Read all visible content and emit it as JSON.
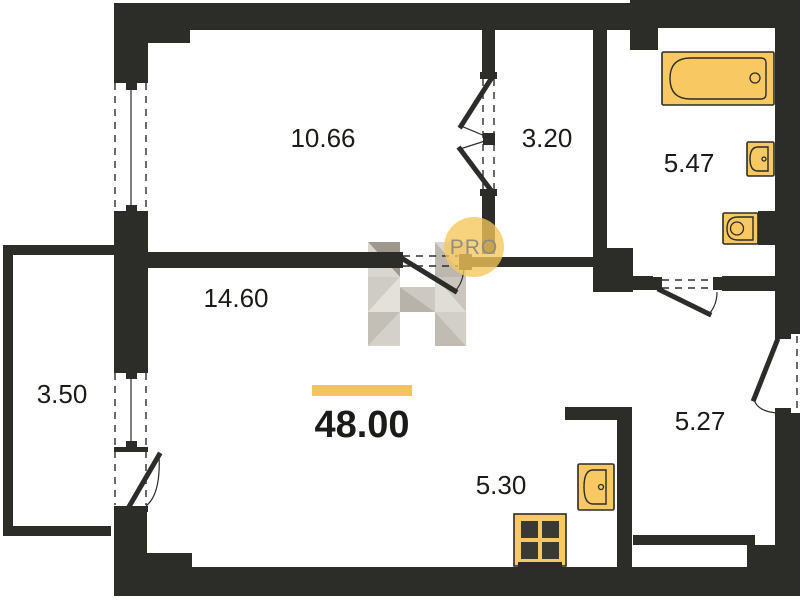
{
  "plan_title": "Apartment floor plan, total area 48.00 sq.m",
  "colors": {
    "background": "#ffffff",
    "wall": "#2c2c29",
    "fixture_fill": "#F8C962",
    "fixture_stroke": "#2b2b27",
    "burner": "#3a3a34",
    "label_text": "#1b1b18",
    "accent_bar": "#F2C461",
    "pro_circle": "#F6C75A",
    "pro_text": "#8b8b84",
    "h_facets": [
      "#9d978d",
      "#d9d6cf",
      "#cfccc5",
      "#e4e1db",
      "#c3bfb7",
      "#d4d1ca",
      "#d9d6cf",
      "#bcb8b0",
      "#cac6bf",
      "#e0ddd7",
      "#d2cfc8",
      "#c0bcb4",
      "#cdc9c2",
      "#b7b3aa"
    ]
  },
  "rooms": [
    {
      "id": "room-top-left",
      "area": "10.66",
      "x": 323,
      "y": 147
    },
    {
      "id": "hallway",
      "area": "3.20",
      "x": 547,
      "y": 147
    },
    {
      "id": "bathroom",
      "area": "5.47",
      "x": 689,
      "y": 172
    },
    {
      "id": "living-room",
      "area": "14.60",
      "x": 236,
      "y": 307
    },
    {
      "id": "balcony",
      "area": "3.50",
      "x": 62,
      "y": 403
    },
    {
      "id": "kitchen",
      "area": "5.30",
      "x": 501,
      "y": 494
    },
    {
      "id": "room-bottom-right",
      "area": "5.27",
      "x": 700,
      "y": 430
    }
  ],
  "total_area": {
    "value": "48.00",
    "x": 362,
    "y": 437,
    "font_size": 38,
    "bar": [
      312,
      385,
      100,
      11
    ]
  },
  "watermark": {
    "pro_text": "PRO",
    "cx": 474,
    "cy": 247,
    "r": 30,
    "text_y": 254
  },
  "geometry": {
    "walls": [
      [
        114,
        3,
        34,
        75
      ],
      [
        148,
        3,
        42,
        40
      ],
      [
        188,
        3,
        442,
        27
      ],
      [
        630,
        0,
        170,
        28
      ],
      [
        630,
        28,
        28,
        22
      ],
      [
        775,
        28,
        25,
        306
      ],
      [
        775,
        413,
        25,
        183
      ],
      [
        190,
        567,
        610,
        29
      ],
      [
        147,
        553,
        45,
        43
      ],
      [
        114,
        512,
        33,
        84
      ],
      [
        114,
        216,
        34,
        151
      ],
      [
        3,
        245,
        112,
        10
      ],
      [
        3,
        245,
        10,
        291
      ],
      [
        3,
        526,
        108,
        10
      ],
      [
        482,
        30,
        13,
        43
      ],
      [
        482,
        196,
        13,
        58
      ],
      [
        148,
        252,
        254,
        16
      ],
      [
        459,
        254,
        13,
        16
      ],
      [
        472,
        257,
        121,
        10
      ],
      [
        593,
        25,
        14,
        225
      ],
      [
        593,
        248,
        40,
        44
      ],
      [
        633,
        276,
        20,
        14
      ],
      [
        722,
        276,
        53,
        15
      ],
      [
        565,
        407,
        67,
        13
      ],
      [
        617,
        420,
        15,
        150
      ],
      [
        633,
        535,
        122,
        10
      ],
      [
        747,
        545,
        28,
        24
      ],
      [
        758,
        211,
        17,
        34
      ]
    ],
    "caps": [
      [
        114,
        77,
        34,
        6
      ],
      [
        126,
        83,
        11,
        7
      ],
      [
        126,
        205,
        11,
        7
      ],
      [
        114,
        211,
        34,
        6
      ],
      [
        114,
        367,
        34,
        6
      ],
      [
        126,
        373,
        11,
        6
      ],
      [
        126,
        441,
        11,
        6
      ],
      [
        114,
        447,
        34,
        5
      ],
      [
        114,
        506,
        34,
        6
      ],
      [
        480,
        72,
        17,
        7
      ],
      [
        480,
        189,
        17,
        7
      ],
      [
        483,
        133,
        12,
        12
      ],
      [
        653,
        277,
        9,
        13
      ],
      [
        713,
        277,
        9,
        13
      ],
      [
        775,
        333,
        16,
        6
      ],
      [
        775,
        408,
        16,
        6
      ],
      [
        395,
        252,
        8,
        16
      ]
    ],
    "dashed_lines": [
      [
        115,
        83,
        115,
        210
      ],
      [
        146,
        83,
        146,
        210
      ],
      [
        115,
        373,
        115,
        505
      ],
      [
        146,
        373,
        146,
        505
      ],
      [
        483,
        79,
        483,
        189
      ],
      [
        494,
        79,
        494,
        189
      ],
      [
        403,
        256,
        458,
        256
      ],
      [
        403,
        266,
        458,
        266
      ],
      [
        662,
        280,
        713,
        280
      ],
      [
        662,
        288,
        713,
        288
      ],
      [
        797,
        336,
        797,
        411
      ]
    ],
    "glazing_lines": [
      [
        131,
        85,
        131,
        205
      ],
      [
        131,
        378,
        131,
        441
      ]
    ],
    "door_panels": [
      [
        491,
        79,
        461,
        126
      ],
      [
        460,
        149,
        490,
        189
      ],
      [
        403,
        259,
        455,
        291
      ],
      [
        660,
        290,
        709,
        314
      ],
      [
        130,
        505,
        159,
        455
      ],
      [
        777,
        341,
        754,
        399
      ]
    ],
    "door_thin_lines": [
      [
        461,
        126,
        485,
        136
      ],
      [
        460,
        149,
        485,
        141
      ]
    ],
    "door_arcs": [
      "M455,291 Q463,283 464,268",
      "M709,314 Q717,305 717,292",
      "M159,455 Q161,494 146,506",
      "M754,399 Q757,412 779,413"
    ],
    "h_watermark_polys": [
      "368,242 400,242 400,277",
      "368,242 368,277 400,277",
      "368,277 400,277 368,312",
      "400,277 400,312 368,312",
      "368,312 400,312 368,346",
      "400,312 400,346 368,346",
      "435,242 466,242 466,277",
      "435,242 435,277 466,277",
      "435,277 466,277 466,312",
      "435,277 435,312 466,312",
      "435,312 466,312 466,346",
      "435,312 435,346 466,346",
      "400,287 435,287 435,312",
      "400,287 400,312 435,312"
    ],
    "fixtures": {
      "bathtub": {
        "outer": [
          662,
          52,
          112,
          53
        ],
        "inner": "M 690.5 58 L 761 58 Q 766 58 766 63 L 766 94 Q 766 99 761 99 L 690.5 99 Q 670 99 670 78.5 Q 670 58 690.5 58 Z",
        "drain": [
          755,
          78,
          5
        ]
      },
      "bath_sink": {
        "outer": [
          747,
          142,
          27,
          34
        ],
        "inner": "M 758 147 L 768 147 L 768 171 L 758 171 Q 750 171 750 159 Q 750 147 758 147 Z",
        "drain": [
          764,
          159,
          2
        ]
      },
      "toilet": {
        "outer": [
          723,
          213,
          35,
          31
        ],
        "inner": "M 738 217 L 753 217 L 753 240 L 738 240 Q 727 240 727 228.5 Q 727 217 738 217 Z",
        "drain": [
          737,
          228.5,
          6.5
        ]
      },
      "kitchen_sink": {
        "outer": [
          578,
          464,
          36,
          46
        ],
        "inner": "M 593 470 L 606 470 L 606 504 L 593 504 Q 584 504 584 487 Q 584 470 593 470 Z",
        "drain": [
          601,
          487,
          2.5
        ]
      },
      "stove": {
        "outer": [
          514,
          514,
          52,
          52
        ],
        "burners": [
          [
            521,
            521,
            17,
            17
          ],
          [
            542,
            521,
            17,
            17
          ],
          [
            521,
            542,
            17,
            17
          ],
          [
            542,
            542,
            17,
            17
          ]
        ],
        "base": [
          518,
          562,
          44,
          8
        ]
      }
    }
  }
}
